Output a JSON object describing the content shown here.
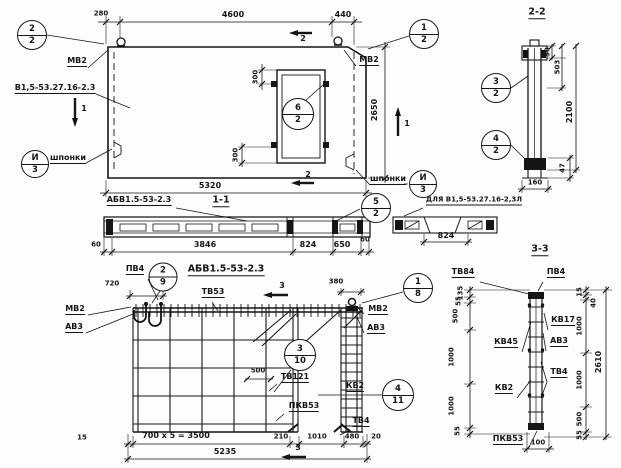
{
  "plan": {
    "mark": "В1,5-53.27.16-2.3",
    "labels": {
      "mv2_left": "МВ2",
      "mv2_right": "МВ2",
      "keys_left": "шпонки",
      "keys_right": "шпонки"
    },
    "dims": {
      "edge": "280",
      "top": "4600",
      "top_right": "440",
      "height": "2650",
      "bottom": "5320",
      "door_top": "300",
      "door_bottom": "300"
    },
    "callouts": {
      "tl": {
        "n": "2",
        "s": "2"
      },
      "tr": {
        "n": "1",
        "s": "2"
      },
      "door": {
        "n": "6",
        "s": "2"
      },
      "keys_left": {
        "n": "И",
        "s": "3"
      },
      "keys_right": {
        "n": "И",
        "s": "3"
      }
    },
    "section_marks": {
      "one_left": "1",
      "one_right": "1",
      "two_top": "2",
      "two_bottom": "2"
    }
  },
  "section_2_2": {
    "title": "2-2",
    "dims": {
      "top": "50",
      "upper": "503",
      "height": "2100",
      "width": "160",
      "toe": "47"
    },
    "callouts": {
      "upper": {
        "n": "3",
        "s": "2"
      },
      "lower": {
        "n": "4",
        "s": "2"
      }
    }
  },
  "section_1_1": {
    "title": "1-1",
    "mesh_mark": "АБВ1.5-53-2.3",
    "dims": {
      "edge_left": "60",
      "body": "3846",
      "opening": "824",
      "right": "650",
      "edge_right": "60"
    },
    "callout": {
      "n": "5",
      "s": "2"
    }
  },
  "detail_l": {
    "label": "ДЛЯ В1,5-53.27.16-2,3Л",
    "dim": "824"
  },
  "elevation": {
    "title": "АБВ1.5-53-2.3",
    "labels": {
      "pv4": "ПВ4",
      "tv53": "ТВ53",
      "mv2_left": "МВ2",
      "av3_left": "АВ3",
      "mv2_right": "МВ2",
      "av3_right": "АВ3",
      "tv121": "ТВ121",
      "kv2": "КВ2",
      "pkv53": "ПКВ53",
      "tv4": "ТВ4"
    },
    "dims": {
      "hook": "720",
      "jamb_top": "380",
      "inner": "500",
      "edge_left": "15",
      "field": "700 x 5 = 3500",
      "gap": "210",
      "opening": "1010",
      "jamb": "480",
      "edge_right": "20",
      "total": "5235"
    },
    "callouts": {
      "pv4": {
        "n": "2",
        "s": "9"
      },
      "corner": {
        "n": "1",
        "s": "8"
      },
      "mesh": {
        "n": "3",
        "s": "10"
      },
      "kv2": {
        "n": "4",
        "s": "11"
      }
    },
    "section_marks": {
      "three_top": "3",
      "three_bottom": "3"
    }
  },
  "section_3_3": {
    "title": "3-3",
    "labels": {
      "tv84": "ТВ84",
      "pv4": "ПВ4",
      "kv17": "КВ17",
      "av3": "АВ3",
      "kv45": "КВ45",
      "tv4": "ТВ4",
      "kv2": "КВ2",
      "pkv53": "ПКВ53"
    },
    "dims_left": [
      "135",
      "55",
      "500",
      "1000",
      "1000",
      "55"
    ],
    "dims_right": [
      "15",
      "40",
      "1000",
      "1000",
      "500",
      "55"
    ],
    "dims": {
      "total": "2610",
      "bottom": "100"
    }
  }
}
